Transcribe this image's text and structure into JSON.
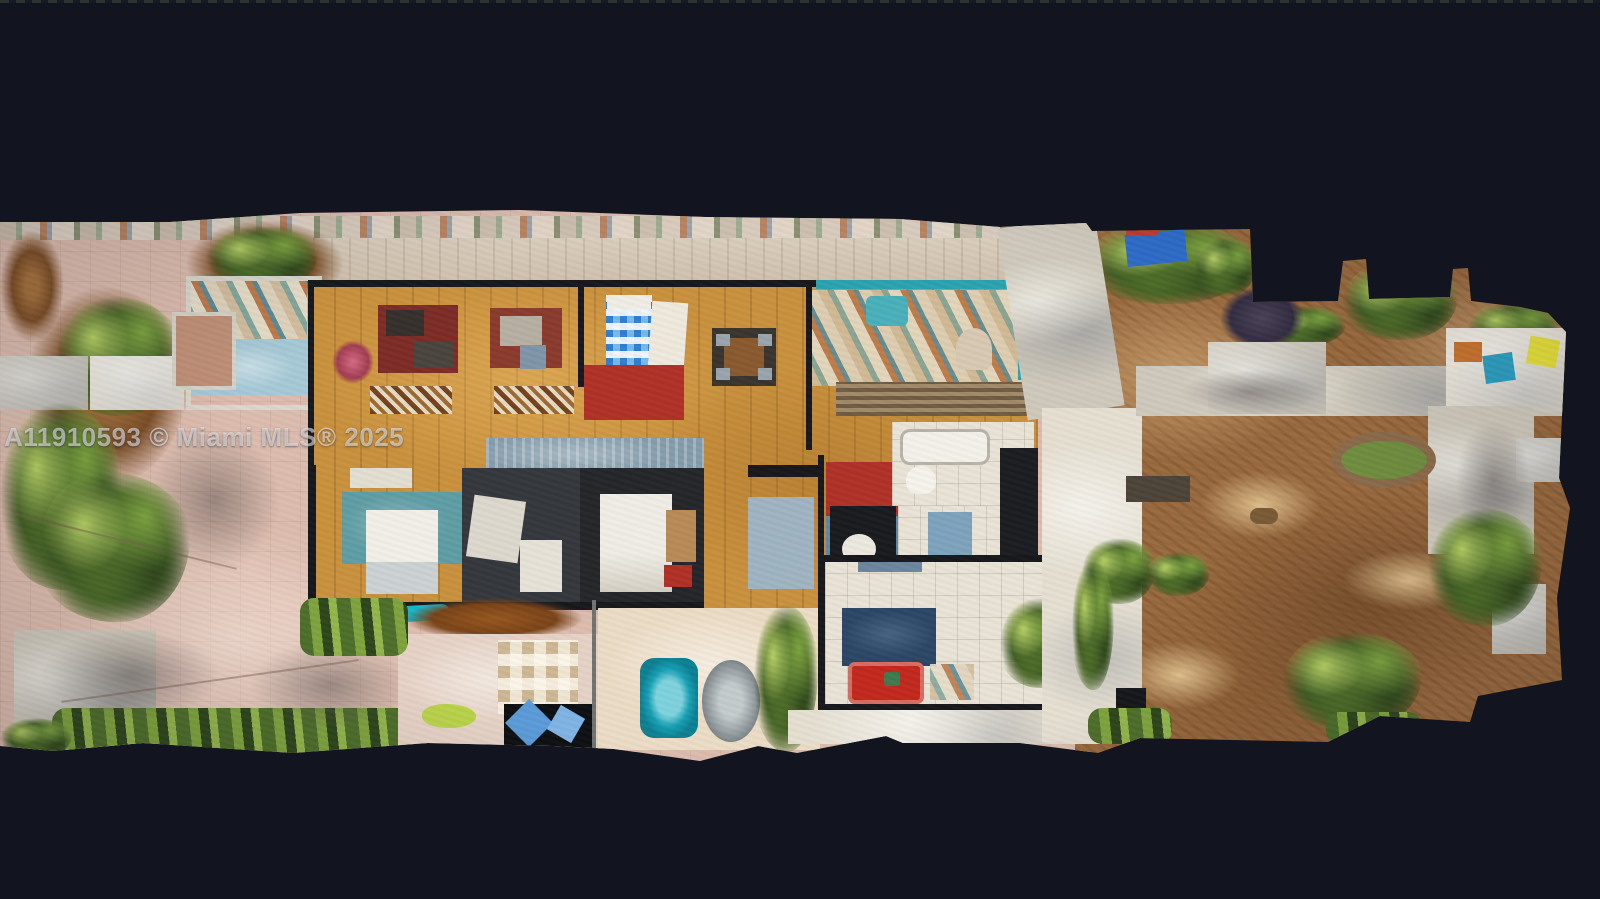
{
  "watermark": {
    "text": "A11910593 © Miami MLS® 2025"
  },
  "palette": {
    "bg": "#12151f",
    "drive_pink": "#dcbcae",
    "dirt": "#9a6a3e",
    "dirt_dark": "#6b4322",
    "dirt_light": "#cfa369",
    "green": "#6d9140",
    "green_dark": "#33501f",
    "green_light": "#aac657",
    "concrete": "#cfc9bc",
    "concrete_light": "#e5dfd2",
    "wood": "#c9913d",
    "hall_blue": "#849cab",
    "teal": "#2aa3b0",
    "teal_rug": "#5f9da4",
    "pool_teal": "#19b5c8",
    "bed_checker_blue": "#2f7fd0",
    "bed_checker_light": "#79b8e8",
    "rug_maroon": "#7e2c26",
    "rug_red": "#b03127",
    "couch_red": "#c2281d",
    "rug_navy": "#2b4766",
    "rug_blue": "#5e87a8",
    "tile": "#e9e3d6",
    "wall": "#17181c",
    "tarp_blue": "#2e6cc9",
    "item_yellow": "#e8e23a",
    "porch_mat": "#a6c9d6"
  },
  "scene": {
    "features": [
      "top-down-3d-scan-of-single-story-house",
      "pink-paver-driveway-left",
      "front-screened-porch",
      "living-room-maroon-rug",
      "blue-checkered-bed",
      "dining-table",
      "teal-kitchen",
      "blue-gray-hallway",
      "bedroom-teal-rug-white-bed",
      "bedroom-red-and-blue-rugs",
      "family-room-red-couch-navy-rug",
      "patio-with-hot-tub",
      "backyard-dirt-right",
      "concrete-paths",
      "garden-shrubs",
      "blue-tarp"
    ]
  }
}
